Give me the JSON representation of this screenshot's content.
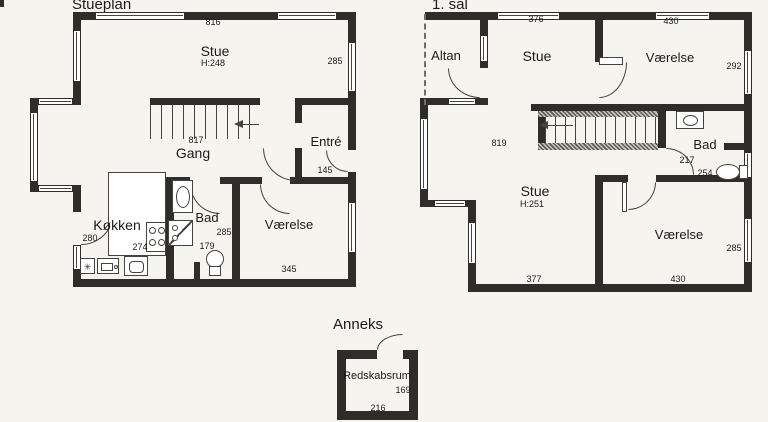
{
  "document_type": "scanned floor plan drawing",
  "colors": {
    "paper": "#f5f4ef",
    "wall": "#2e2d29",
    "line": "#44433f",
    "ink": "#1b1b19"
  },
  "stueplan": {
    "title": "Stueplan",
    "rooms": {
      "stue": {
        "name": "Stue",
        "ceiling_height": "H:248"
      },
      "gang": {
        "name": "Gang"
      },
      "entre": {
        "name": "Entré"
      },
      "kokken": {
        "name": "Køkken"
      },
      "bad": {
        "name": "Bad"
      },
      "vaerelse": {
        "name": "Værelse"
      }
    },
    "measurements": {
      "facade_top": "816",
      "window_right": "285",
      "stairs": "817",
      "entre": "145",
      "kokken_width": "280",
      "kokken_depth": "274",
      "bad_depth": "285",
      "bad_width": "179",
      "vaerelse_width": "345"
    }
  },
  "first_floor": {
    "title": "1. sal",
    "rooms": {
      "altan": {
        "name": "Altan"
      },
      "stue_top": {
        "name": "Stue"
      },
      "vaerelse_top": {
        "name": "Værelse"
      },
      "bad": {
        "name": "Bad"
      },
      "stue_bottom": {
        "name": "Stue",
        "ceiling_height": "H:251"
      },
      "vaerelse_bottom": {
        "name": "Værelse"
      }
    },
    "measurements": {
      "window_top_left": "376",
      "window_top_right": "430",
      "window_right_top": "292",
      "stairs": "819",
      "bad_door": "217",
      "bad_width": "254",
      "stue_width": "377",
      "vaerelse_width": "430",
      "window_right_bottom": "285"
    }
  },
  "anneks": {
    "title": "Anneks",
    "rooms": {
      "redskabsrum": {
        "name": "Redskabsrum"
      }
    },
    "measurements": {
      "depth": "169",
      "width": "216"
    }
  },
  "icons": {
    "freezer_glyph": "✳"
  }
}
